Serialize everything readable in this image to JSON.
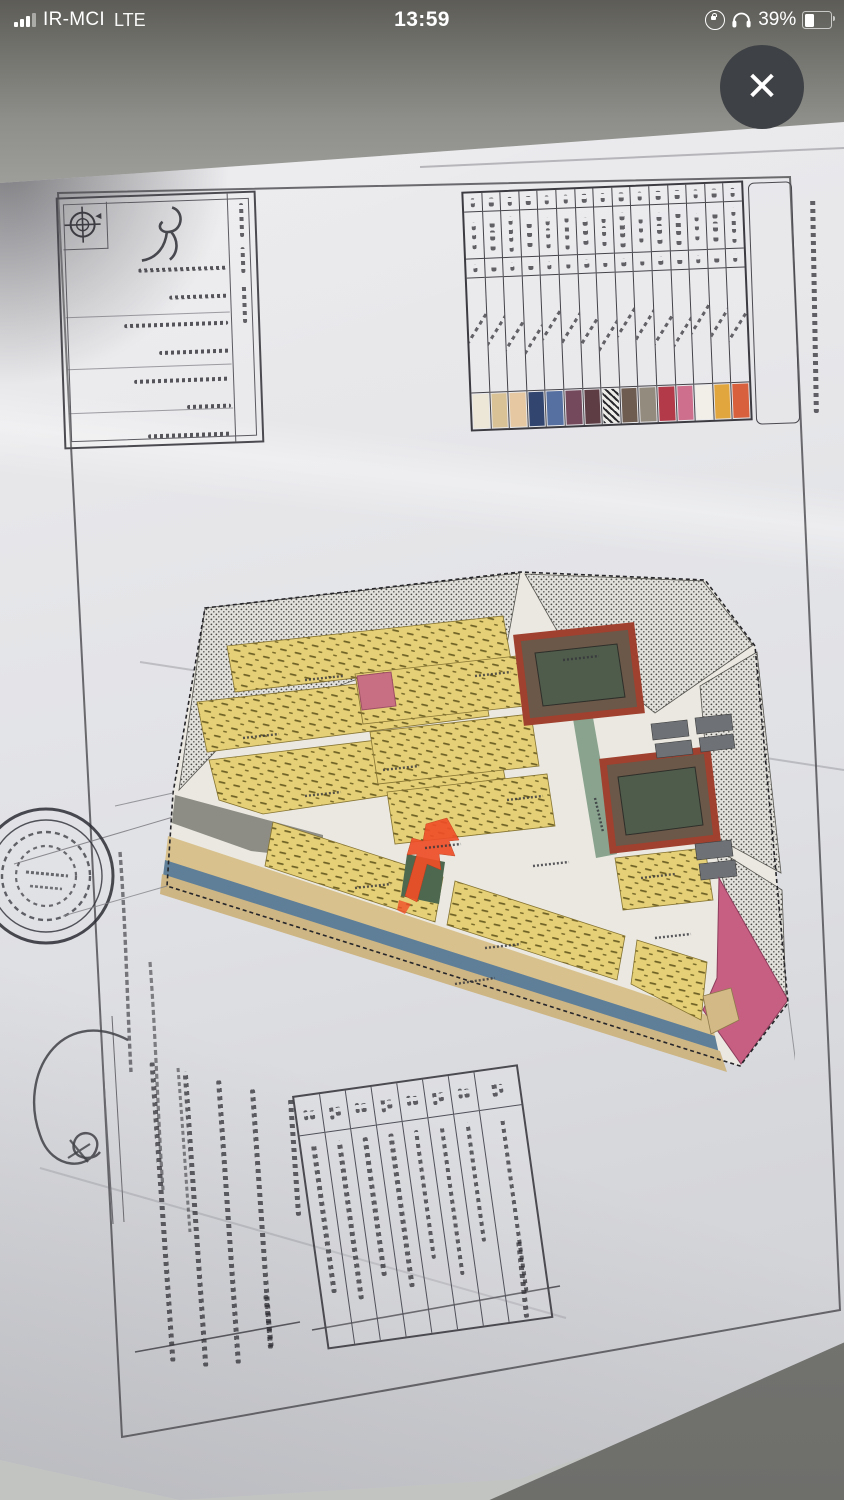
{
  "status_bar": {
    "signal_icon": "signal-bars",
    "carrier": "IR-MCI",
    "network": "LTE",
    "time": "13:59",
    "rotation_lock_icon": "rotation-lock",
    "headphones_icon": "headphones",
    "battery_percent": "39%",
    "battery_level": 0.39
  },
  "viewer": {
    "close_glyph": "✕"
  },
  "photo": {
    "content": "hand-photographed land subdivision site plan with Persian handwriting (illegible at this resolution)",
    "colors": {
      "parcel_yellow": "#e5d077",
      "school_border_red": "#a0402f",
      "school_fill_green": "#4f5c4b",
      "boulevard_blue": "#5f7f98",
      "edge_tan": "#d8c18d",
      "reserve_pink": "#c96f84",
      "corner_magenta": "#c75f82",
      "green_street": "#7e9b85",
      "marker_arrow_red": "#ef4f28",
      "park_green": "#4d684e",
      "hatch_fill": "#e2e1dc"
    },
    "legend": {
      "column_count": 15,
      "swatches": [
        "#ece7d6",
        "#d9c296",
        "#e6c9a2",
        "#31456e",
        "#5670a2",
        "#74495c",
        "#5e3d45",
        "hatch",
        "#6e5c50",
        "#948b7f",
        "#b23a49",
        "#cd6f8d",
        "#f2efe9",
        "#e2a63e",
        "#d8603c"
      ]
    },
    "bottom_table": {
      "column_count": 8,
      "body_squig_heights": [
        150,
        160,
        140,
        155,
        130,
        150,
        120,
        175
      ]
    },
    "notes": {
      "line_heights": [
        300,
        296,
        284,
        260,
        118
      ]
    }
  }
}
